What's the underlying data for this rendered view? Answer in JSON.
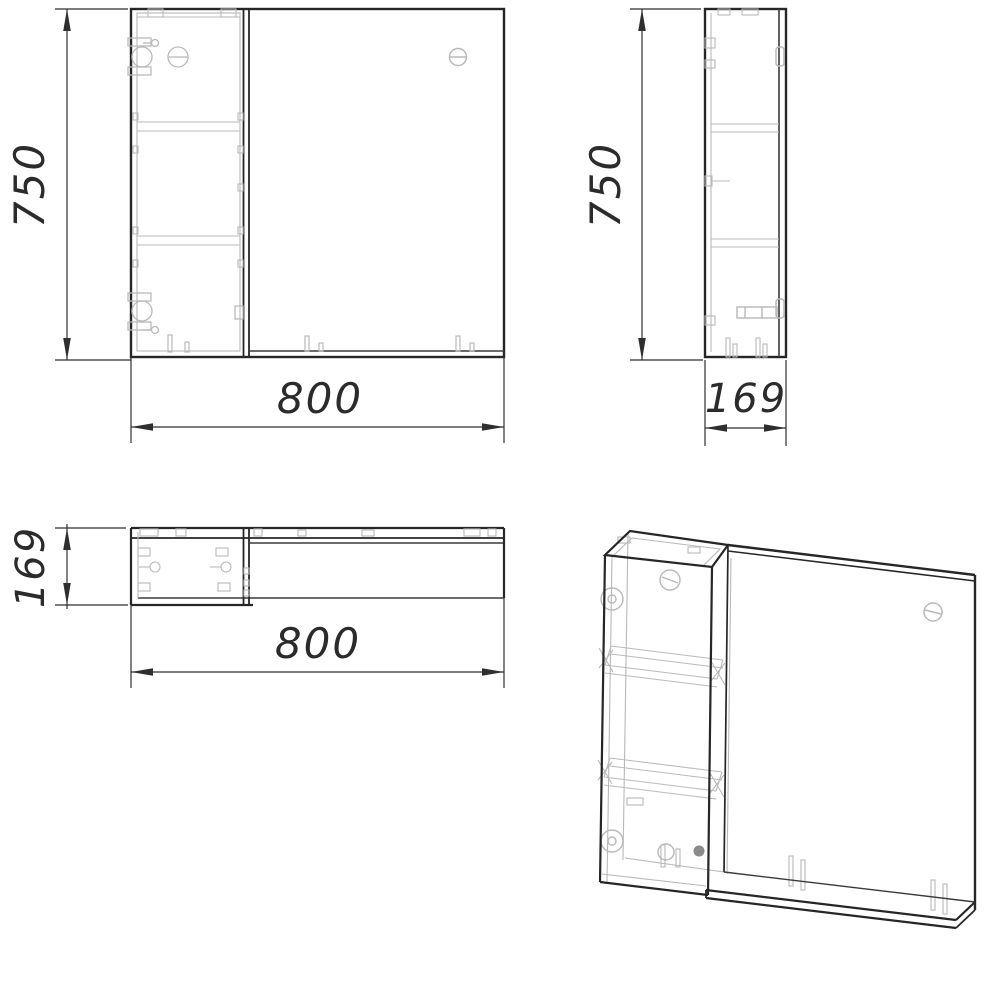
{
  "colors": {
    "background": "#ffffff",
    "outline": "#262626",
    "detail_gray": "#b9b9b9",
    "dimension": "#2e2e2e"
  },
  "views": {
    "front": {
      "name": "front view",
      "dim_height": "750",
      "dim_width": "800"
    },
    "side": {
      "name": "side view",
      "dim_height": "750",
      "dim_depth": "169"
    },
    "top": {
      "name": "top view",
      "dim_depth": "169",
      "dim_width": "800"
    },
    "isometric": {
      "name": "isometric view"
    }
  }
}
